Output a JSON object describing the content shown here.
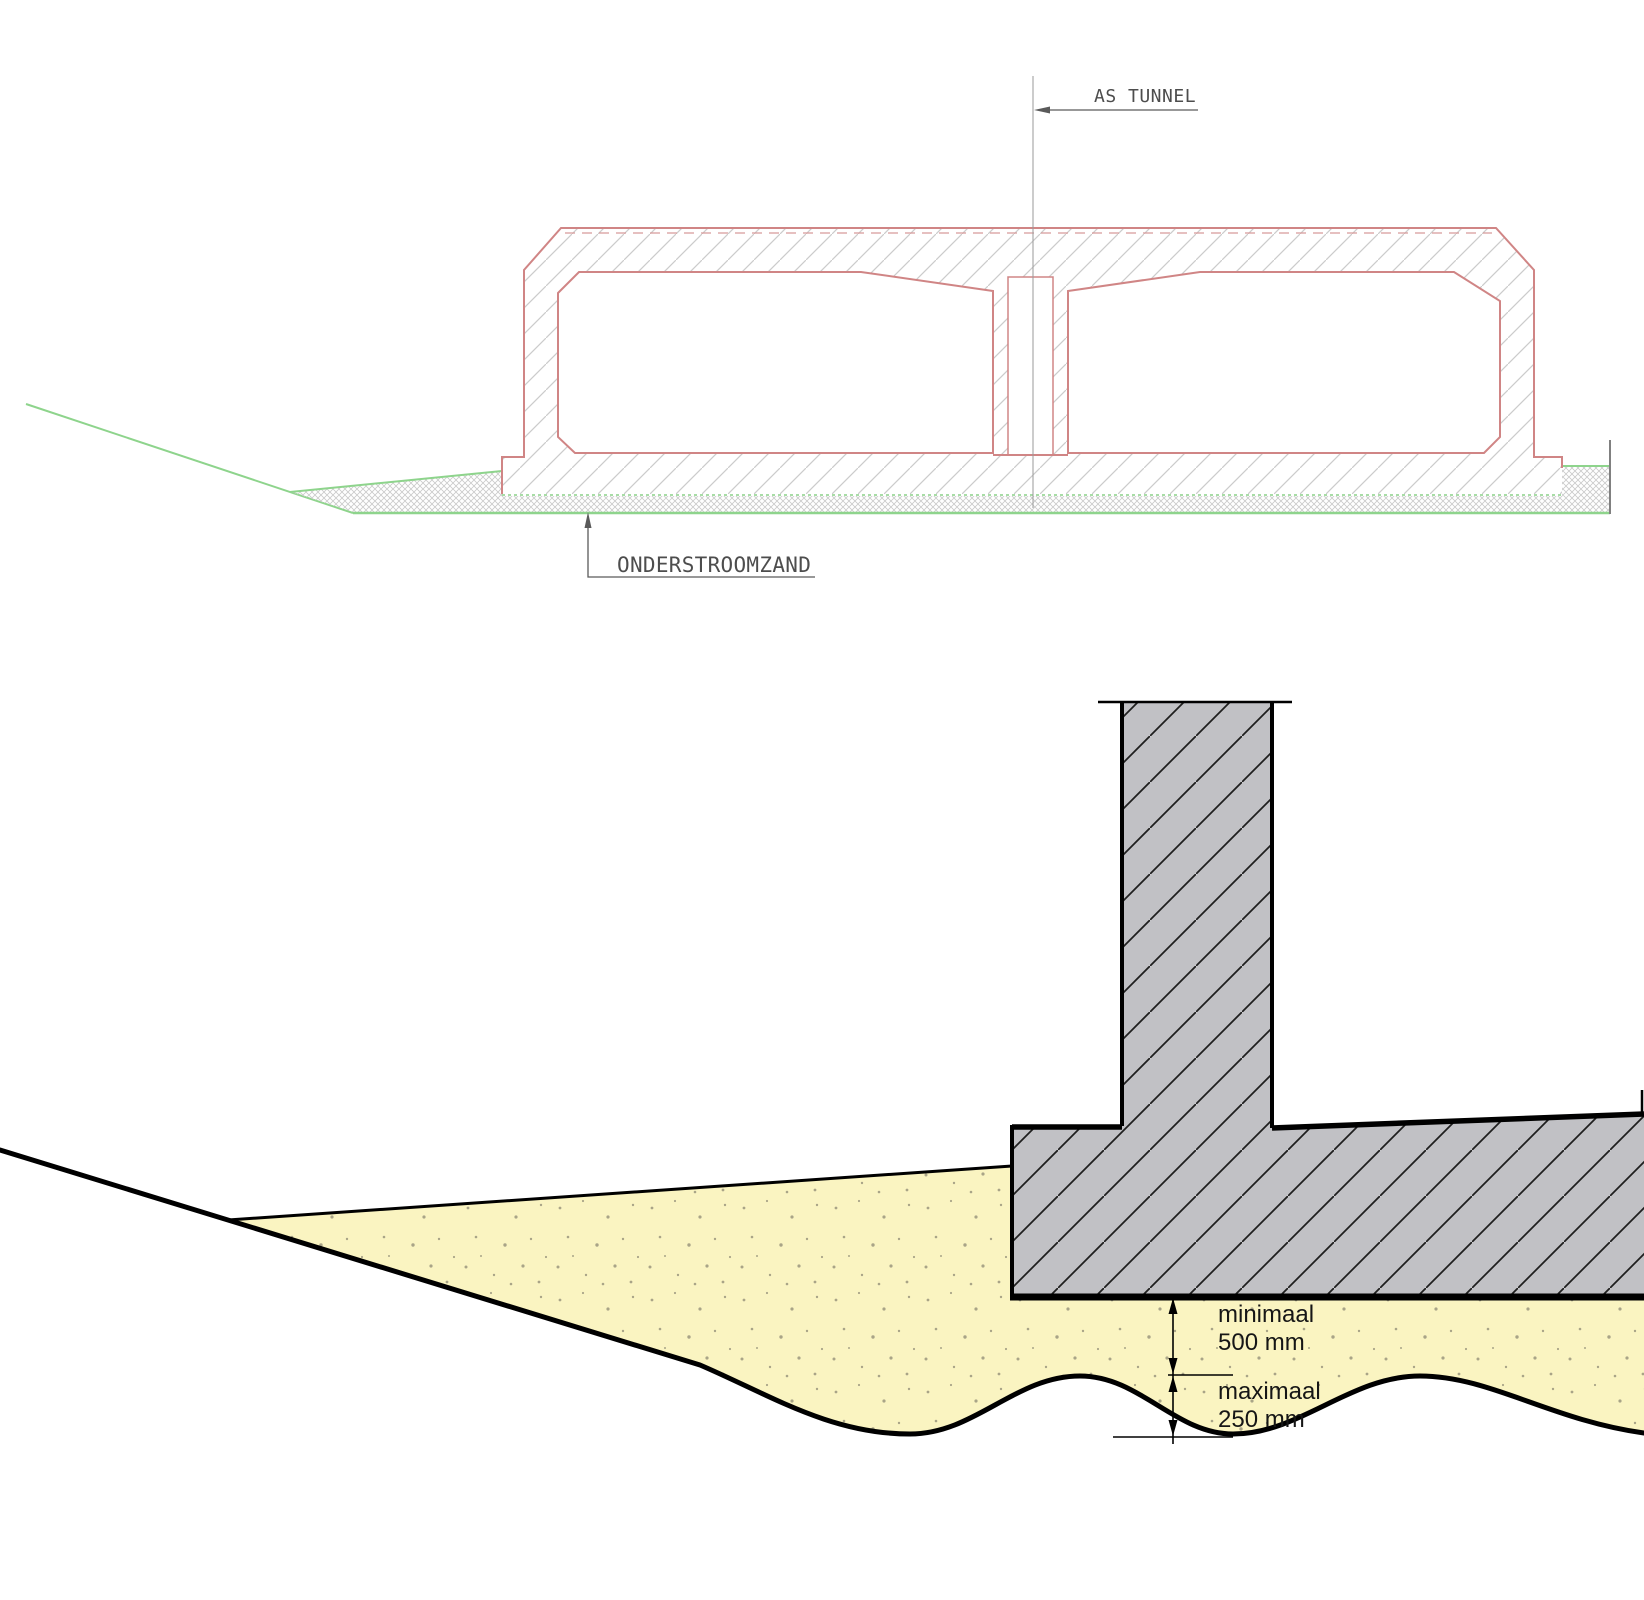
{
  "document_type": "tunnel construction technical drawing",
  "top_drawing": {
    "axis_label": "AS TUNNEL",
    "sand_label": "ONDERSTROOMZAND",
    "colors": {
      "outline_pink": "#d08585",
      "ground_green": "#8ed48c",
      "hatch_gray": "#cbcbcb",
      "sand_mesh_gray": "#c9c9c9",
      "centerline_gray": "#9a9a9a",
      "leader_gray": "#5a5a5a"
    }
  },
  "bottom_drawing": {
    "dimensions": [
      {
        "label": "minimaal",
        "value": "500 mm"
      },
      {
        "label": "maximaal",
        "value": "250 mm"
      }
    ],
    "colors": {
      "concrete_gray": "#c1c1c5",
      "sand_yellow": "#faf4c1",
      "line_black": "#000000"
    }
  }
}
